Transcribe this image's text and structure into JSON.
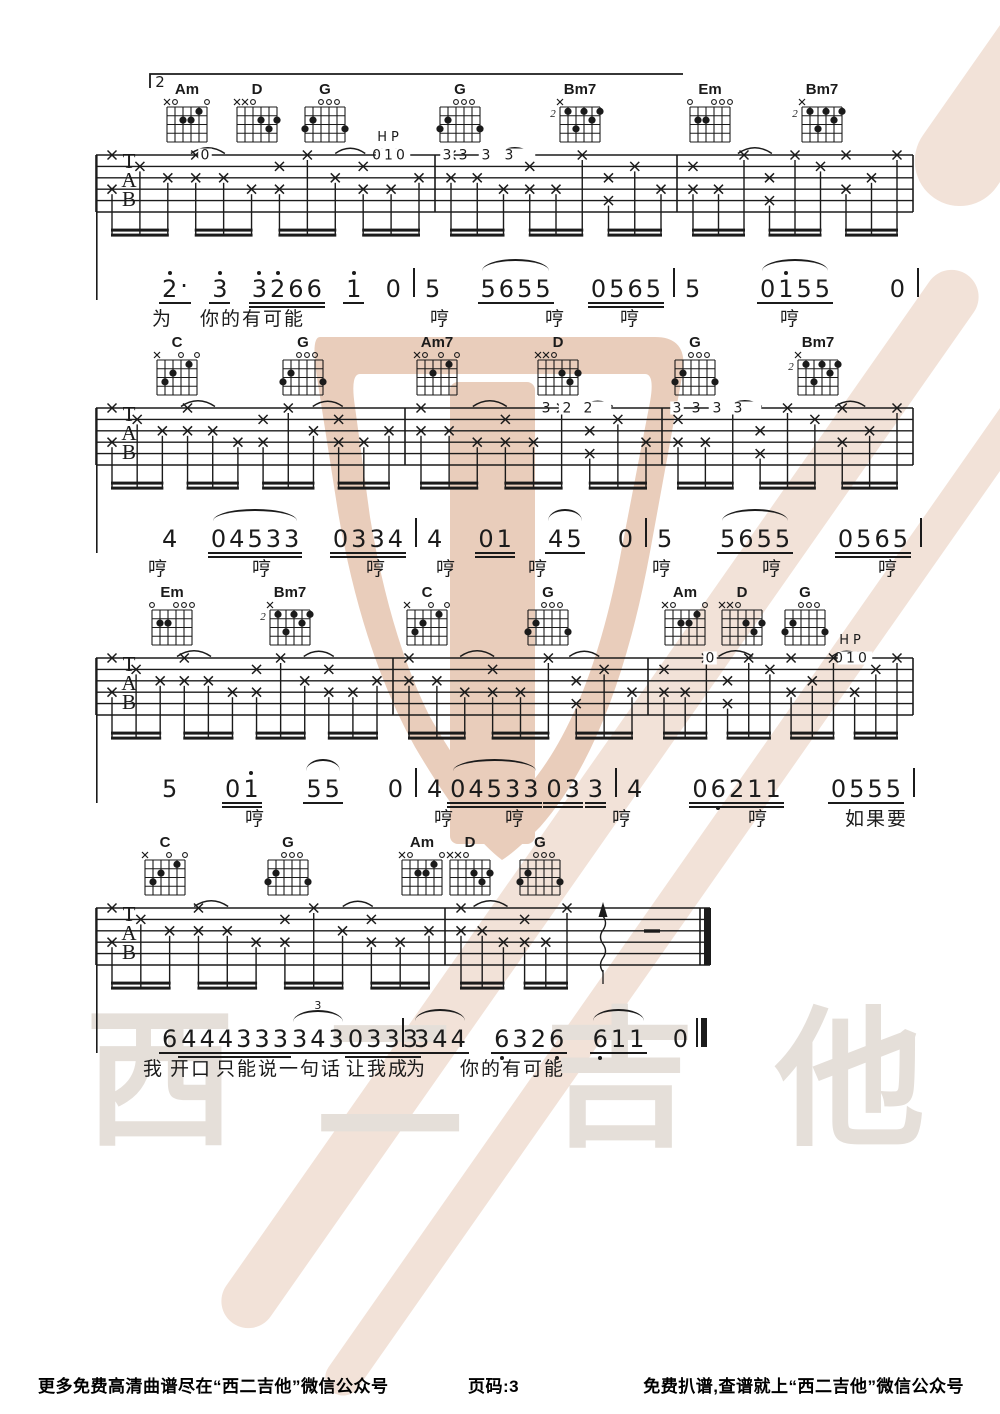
{
  "page": {
    "width": 1000,
    "height": 1414,
    "background": "#ffffff",
    "ink": "#1b1b1b"
  },
  "volta": {
    "label": "2"
  },
  "tab_letters": [
    "T",
    "A",
    "B"
  ],
  "watermark": {
    "text": "西二吉他",
    "text_color": "#e5dfd9",
    "logo_color": "#e9cdbb",
    "swoosh_color": "#f2e2d8"
  },
  "footer": {
    "left": "更多免费高清曲谱尽在“西二吉他”微信公众号",
    "center": "页码:3",
    "right": "免费扒谱,查谱就上“西二吉他”微信公众号"
  },
  "chord_shapes": {
    "Am": {
      "mute": [
        6
      ],
      "open": [
        5,
        1
      ],
      "dots": [
        [
          4,
          2
        ],
        [
          3,
          2
        ],
        [
          2,
          1
        ]
      ]
    },
    "Am7": {
      "mute": [
        6
      ],
      "open": [
        5,
        3,
        1
      ],
      "dots": [
        [
          4,
          2
        ],
        [
          2,
          1
        ]
      ]
    },
    "C": {
      "mute": [
        6
      ],
      "open": [
        3,
        1
      ],
      "dots": [
        [
          5,
          3
        ],
        [
          4,
          2
        ],
        [
          2,
          1
        ]
      ]
    },
    "D": {
      "mute": [
        6,
        5
      ],
      "open": [
        4
      ],
      "dots": [
        [
          3,
          2
        ],
        [
          2,
          3
        ],
        [
          1,
          2
        ]
      ]
    },
    "G": {
      "mute": [],
      "open": [
        4,
        3,
        2
      ],
      "dots": [
        [
          6,
          3
        ],
        [
          5,
          2
        ],
        [
          1,
          3
        ]
      ]
    },
    "Em": {
      "mute": [],
      "open": [
        6,
        3,
        2,
        1
      ],
      "dots": [
        [
          5,
          2
        ],
        [
          4,
          2
        ]
      ]
    },
    "Bm7": {
      "base": "2",
      "mute": [
        6
      ],
      "open": [],
      "dots": [
        [
          5,
          1
        ],
        [
          3,
          1
        ],
        [
          1,
          1
        ],
        [
          2,
          2
        ],
        [
          4,
          3
        ]
      ]
    }
  },
  "systems": [
    {
      "top": 155,
      "end": 913,
      "bars": [
        96,
        435,
        677,
        913
      ],
      "chords": [
        {
          "n": "Am",
          "x": 187
        },
        {
          "n": "D",
          "x": 257
        },
        {
          "n": "G",
          "x": 325
        },
        {
          "n": "G",
          "x": 460
        },
        {
          "n": "Bm7",
          "x": 580
        },
        {
          "n": "Em",
          "x": 710
        },
        {
          "n": "Bm7",
          "x": 822
        }
      ],
      "ann": [
        {
          "t": "0",
          "x": 205
        },
        {
          "t": "HP",
          "x": 390,
          "hp": 1
        },
        {
          "t": "010",
          "x": 393,
          "ls": 3
        },
        {
          "t": "3",
          "x": 447
        },
        {
          "t": "333",
          "x": 507,
          "ls": 14
        }
      ]
    },
    {
      "top": 408,
      "end": 913,
      "bars": [
        96,
        405,
        662,
        913
      ],
      "chords": [
        {
          "n": "C",
          "x": 177
        },
        {
          "n": "G",
          "x": 303
        },
        {
          "n": "Am7",
          "x": 437
        },
        {
          "n": "D",
          "x": 558
        },
        {
          "n": "G",
          "x": 695
        },
        {
          "n": "Bm7",
          "x": 818
        }
      ],
      "ann": [
        {
          "t": "322",
          "x": 585,
          "ls": 12
        },
        {
          "t": "3",
          "x": 677
        },
        {
          "t": "333",
          "x": 735,
          "ls": 12
        }
      ]
    },
    {
      "top": 658,
      "end": 913,
      "bars": [
        96,
        393,
        648,
        913
      ],
      "chords": [
        {
          "n": "Em",
          "x": 172
        },
        {
          "n": "Bm7",
          "x": 290
        },
        {
          "n": "C",
          "x": 427
        },
        {
          "n": "G",
          "x": 548
        },
        {
          "n": "Am",
          "x": 685
        },
        {
          "n": "D",
          "x": 742
        },
        {
          "n": "G",
          "x": 805
        }
      ],
      "ann": [
        {
          "t": "0",
          "x": 710
        },
        {
          "t": "HP",
          "x": 852,
          "hp": 1
        },
        {
          "t": "010",
          "x": 855,
          "ls": 3
        }
      ]
    },
    {
      "top": 908,
      "end": 710,
      "bars": [
        96,
        445,
        710
      ],
      "final": true,
      "strum": 603,
      "dash": 652,
      "chords": [
        {
          "n": "C",
          "x": 165
        },
        {
          "n": "G",
          "x": 288
        },
        {
          "n": "Am",
          "x": 422
        },
        {
          "n": "D",
          "x": 470
        },
        {
          "n": "G",
          "x": 540
        }
      ],
      "ann": []
    }
  ],
  "jianpu": [
    {
      "y": 265,
      "measures": [
        {
          "x0": 150,
          "x1": 413,
          "groups": [
            {
              "u": 1,
              "n": [
                "2'*"
              ]
            },
            {
              "u": 1,
              "n": [
                "3'"
              ]
            },
            {
              "u": 2,
              "n": [
                "3'",
                "2'",
                "6",
                "6"
              ]
            },
            {
              "u": 1,
              "n": [
                "1'"
              ]
            },
            {
              "u": 0,
              "n": [
                "0"
              ]
            }
          ]
        },
        {
          "x0": 413,
          "x1": 673,
          "groups": [
            {
              "u": 0,
              "n": [
                "5"
              ]
            },
            {
              "u": 1,
              "arc": true,
              "n": [
                "5",
                "6",
                "5",
                "5"
              ]
            },
            {
              "u": 2,
              "n": [
                "0",
                "5",
                "6",
                "5"
              ]
            }
          ]
        },
        {
          "x0": 673,
          "x1": 917,
          "groups": [
            {
              "u": 0,
              "n": [
                "5"
              ]
            },
            {
              "u": 1,
              "arc": true,
              "n": [
                "0",
                "1'",
                "5",
                "5"
              ]
            },
            {
              "u": 0,
              "n": [
                "0"
              ]
            }
          ]
        }
      ],
      "lyrics": [
        {
          "t": "为",
          "x": 152
        },
        {
          "t": "你的有可能",
          "x": 200
        },
        {
          "t": "哼",
          "x": 430
        },
        {
          "t": "哼",
          "x": 545
        },
        {
          "t": "哼",
          "x": 620
        },
        {
          "t": "哼",
          "x": 780
        }
      ]
    },
    {
      "y": 515,
      "measures": [
        {
          "x0": 150,
          "x1": 415,
          "groups": [
            {
              "u": 0,
              "n": [
                "4"
              ]
            },
            {
              "u": 2,
              "arc": true,
              "n": [
                "0",
                "4",
                "5",
                "3",
                "3"
              ]
            },
            {
              "u": 2,
              "n": [
                "0",
                "3",
                "3",
                "4"
              ]
            }
          ]
        },
        {
          "x0": 415,
          "x1": 645,
          "groups": [
            {
              "u": 0,
              "n": [
                "4"
              ]
            },
            {
              "u": 2,
              "n": [
                "0",
                "1"
              ]
            },
            {
              "u": 1,
              "arc": true,
              "n": [
                "4",
                "5"
              ]
            },
            {
              "u": 0,
              "n": [
                "0"
              ]
            }
          ]
        },
        {
          "x0": 645,
          "x1": 920,
          "groups": [
            {
              "u": 0,
              "n": [
                "5"
              ]
            },
            {
              "u": 1,
              "arc": true,
              "n": [
                "5",
                "6",
                "5",
                "5"
              ]
            },
            {
              "u": 2,
              "n": [
                "0",
                "5",
                "6",
                "5"
              ]
            }
          ]
        }
      ],
      "lyrics": [
        {
          "t": "哼",
          "x": 148
        },
        {
          "t": "哼",
          "x": 252
        },
        {
          "t": "哼",
          "x": 366
        },
        {
          "t": "哼",
          "x": 436
        },
        {
          "t": "哼",
          "x": 528
        },
        {
          "t": "哼",
          "x": 652
        },
        {
          "t": "哼",
          "x": 762
        },
        {
          "t": "哼",
          "x": 878
        }
      ]
    },
    {
      "y": 765,
      "measures": [
        {
          "x0": 150,
          "x1": 415,
          "groups": [
            {
              "u": 0,
              "n": [
                "5"
              ]
            },
            {
              "u": 2,
              "n": [
                "0",
                "1'"
              ]
            },
            {
              "u": 1,
              "arc": true,
              "n": [
                "5",
                "5"
              ]
            },
            {
              "u": 0,
              "n": [
                "0"
              ]
            }
          ]
        },
        {
          "x0": 415,
          "x1": 615,
          "groups": [
            {
              "u": 0,
              "n": [
                "4"
              ]
            },
            {
              "u": 2,
              "arc": true,
              "n": [
                "0",
                "4",
                "5",
                "3",
                "3"
              ]
            },
            {
              "u": 2,
              "n": [
                "0",
                "3"
              ]
            },
            {
              "u": 2,
              "n": [
                "3"
              ]
            }
          ]
        },
        {
          "x0": 615,
          "x1": 913,
          "groups": [
            {
              "u": 0,
              "n": [
                "4"
              ]
            },
            {
              "u": 2,
              "n": [
                "0",
                "6,",
                "2",
                "1",
                "1"
              ]
            },
            {
              "u": 1,
              "n": [
                "0",
                "5",
                "5",
                "5"
              ]
            }
          ]
        }
      ],
      "lyrics": [
        {
          "t": "哼",
          "x": 245
        },
        {
          "t": "哼",
          "x": 434
        },
        {
          "t": "哼",
          "x": 505
        },
        {
          "t": "哼",
          "x": 612
        },
        {
          "t": "哼",
          "x": 748
        },
        {
          "t": "如果要",
          "x": 845
        }
      ]
    },
    {
      "y": 1015,
      "measures": [
        {
          "x0": 150,
          "x1": 402,
          "groups": [
            {
              "u": 1,
              "n": [
                "6"
              ]
            },
            {
              "u": 2,
              "n": [
                "4",
                "4",
                "4",
                "3",
                "3",
                "3"
              ]
            },
            {
              "u": 1,
              "tri": true,
              "n": [
                "3",
                "4",
                "3"
              ]
            },
            {
              "u": 2,
              "n": [
                "0",
                "3",
                "3",
                "3"
              ]
            }
          ]
        },
        {
          "x0": 402,
          "x1": 700,
          "bar": "final",
          "groups": [
            {
              "u": 1,
              "arc": true,
              "n": [
                "3",
                "4",
                "4"
              ]
            },
            {
              "u": 1,
              "n": [
                "6,",
                "3",
                "2",
                "6,"
              ]
            },
            {
              "u": 1,
              "arc": true,
              "n": [
                "6,",
                "1",
                "1"
              ]
            },
            {
              "u": 0,
              "n": [
                "0"
              ]
            }
          ]
        }
      ],
      "lyrics": [
        {
          "t": "我",
          "x": 143
        },
        {
          "t": "开口",
          "x": 170
        },
        {
          "t": "只能说一句话",
          "x": 216
        },
        {
          "t": "让我成",
          "x": 346
        },
        {
          "t": "为",
          "x": 406
        },
        {
          "t": "你的有可能",
          "x": 460
        }
      ]
    }
  ]
}
